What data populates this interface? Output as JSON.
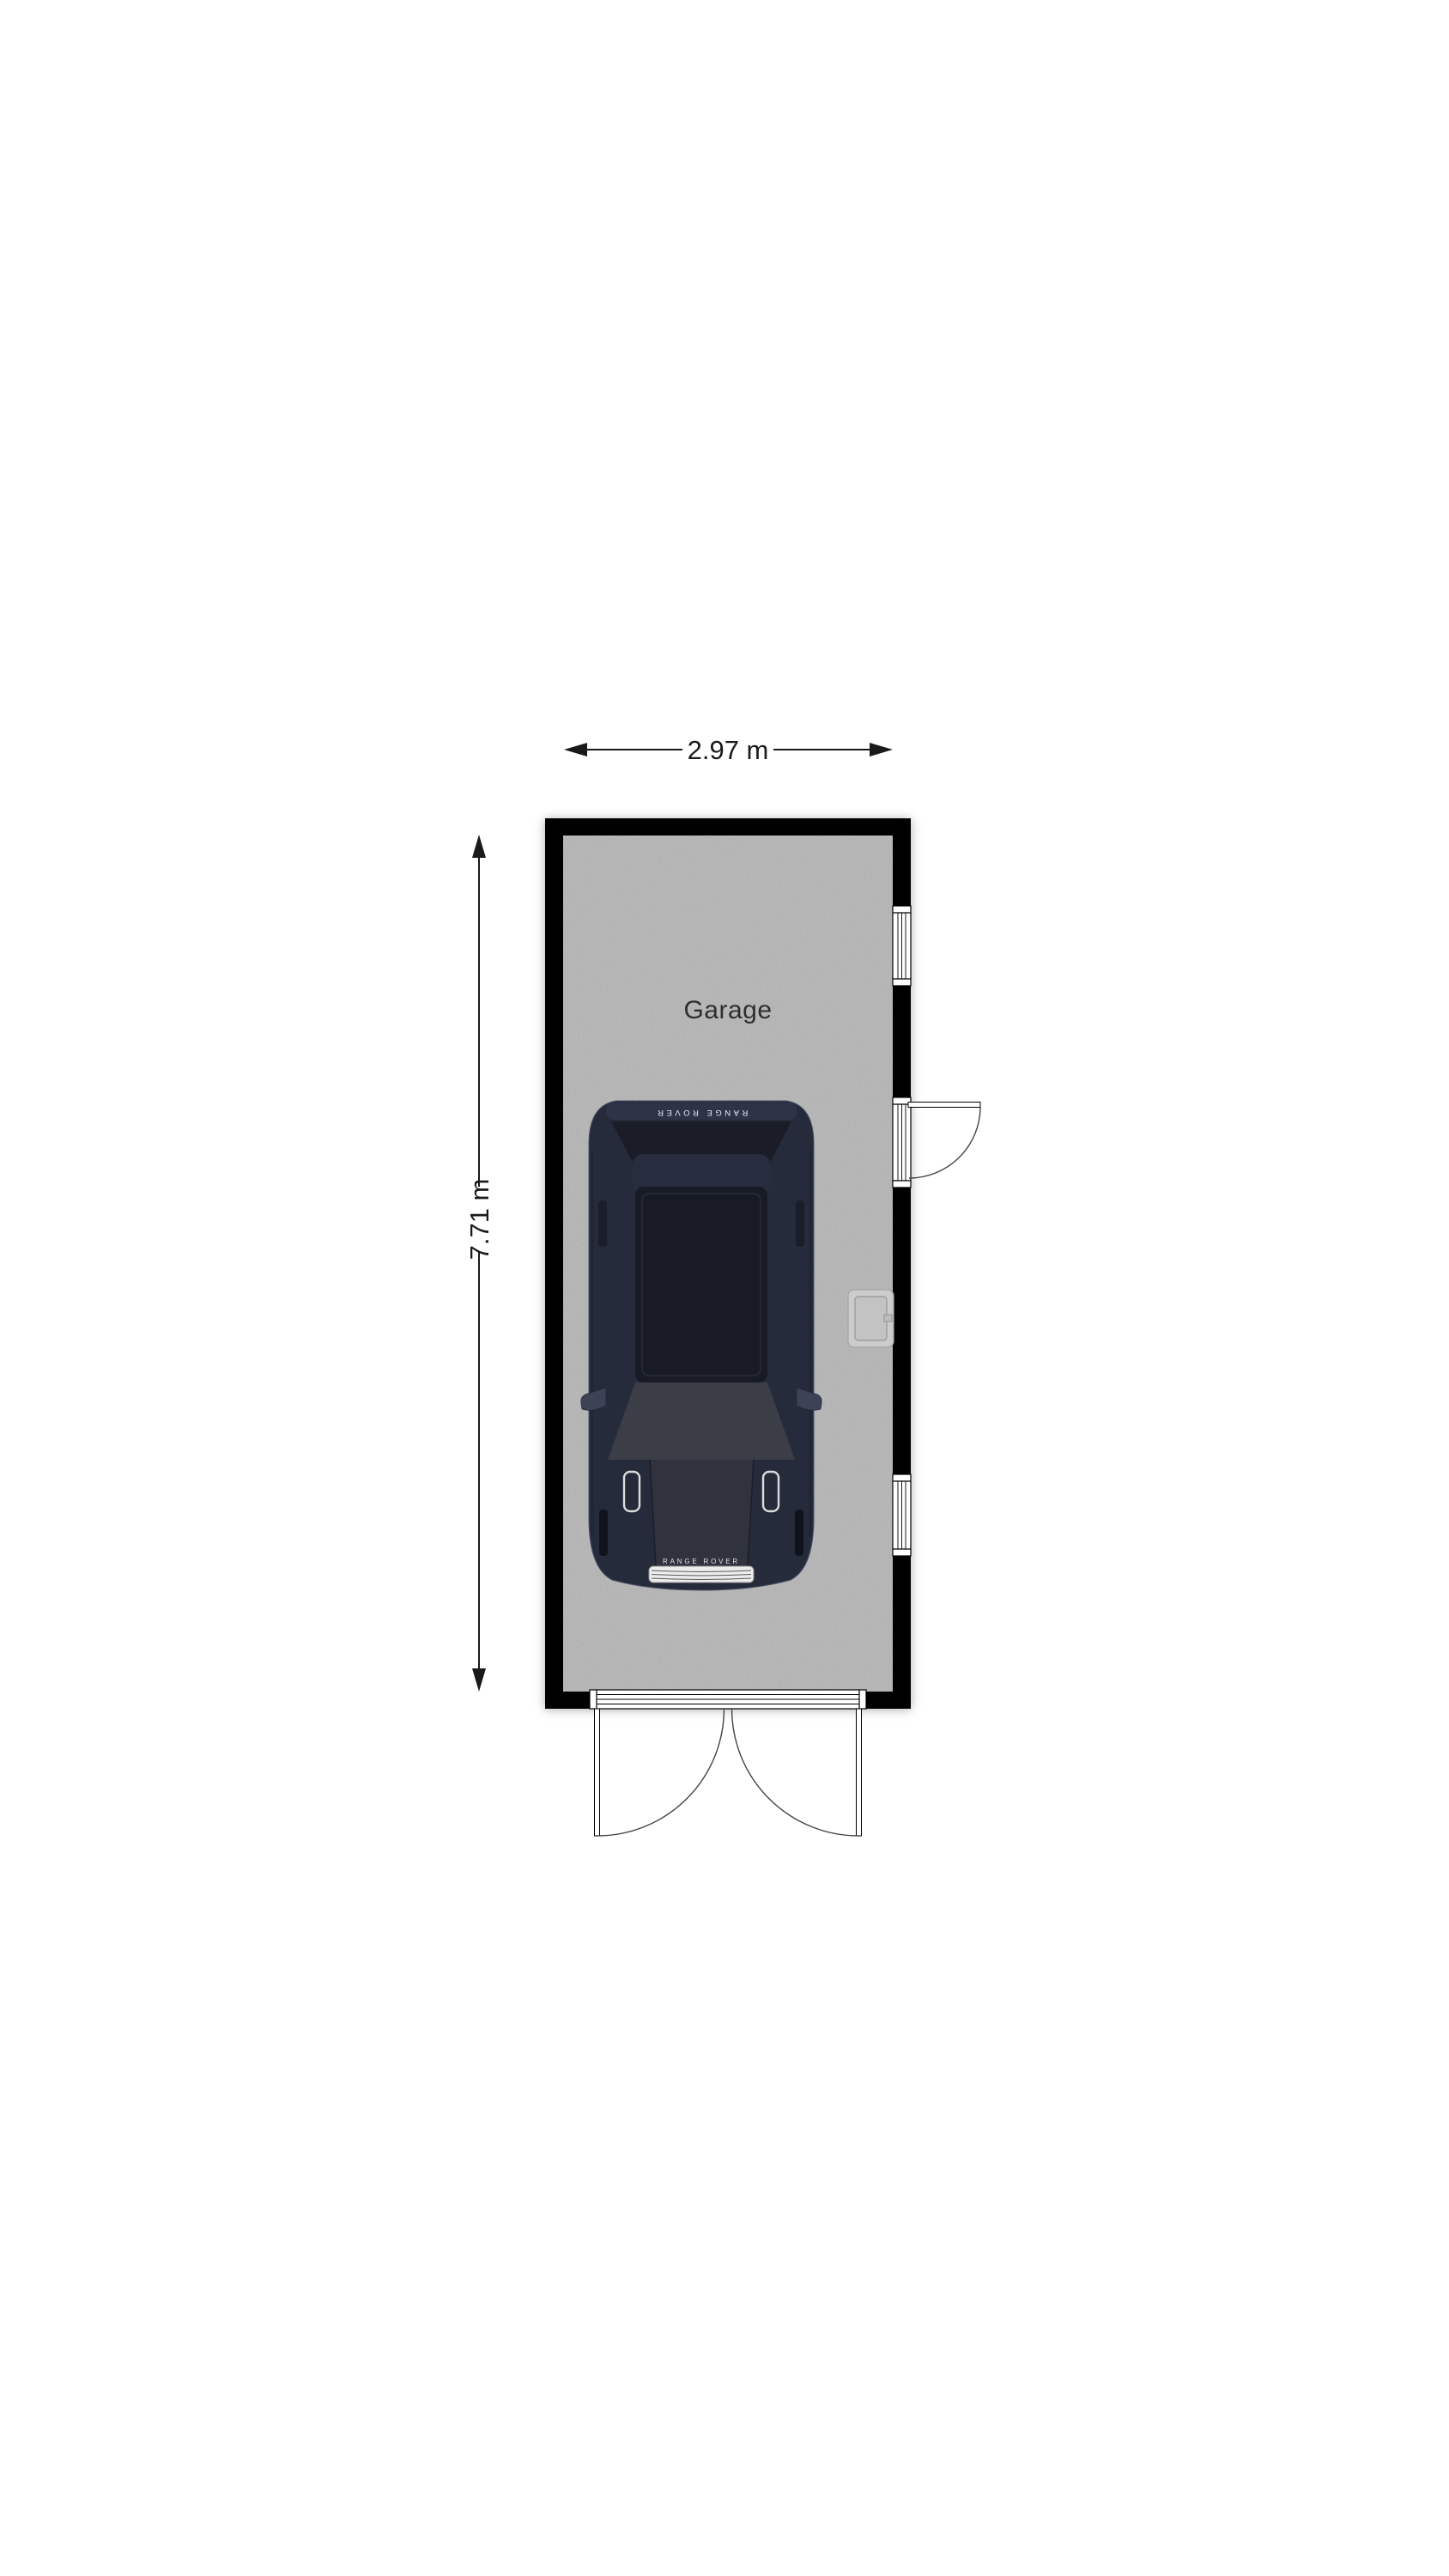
{
  "floorplan": {
    "room_label": "Garage",
    "dimensions": {
      "width_label": "2.97 m",
      "height_label": "7.71 m"
    },
    "car": {
      "rear_badge": "RANGE ROVER",
      "front_badge": "RANGE ROVER"
    },
    "colors": {
      "wall": "#000000",
      "floor": "#b5b5b5",
      "dimension_line": "#1a1a1a",
      "room_label_text": "#2e2e2e",
      "car_body": "#262b3b",
      "car_roof_glass": "#181b26",
      "car_rear_glass": "#1a1d27",
      "car_windshield": "#3b3e47",
      "door_swing": "#444444",
      "opening_frame": "#000000"
    }
  }
}
